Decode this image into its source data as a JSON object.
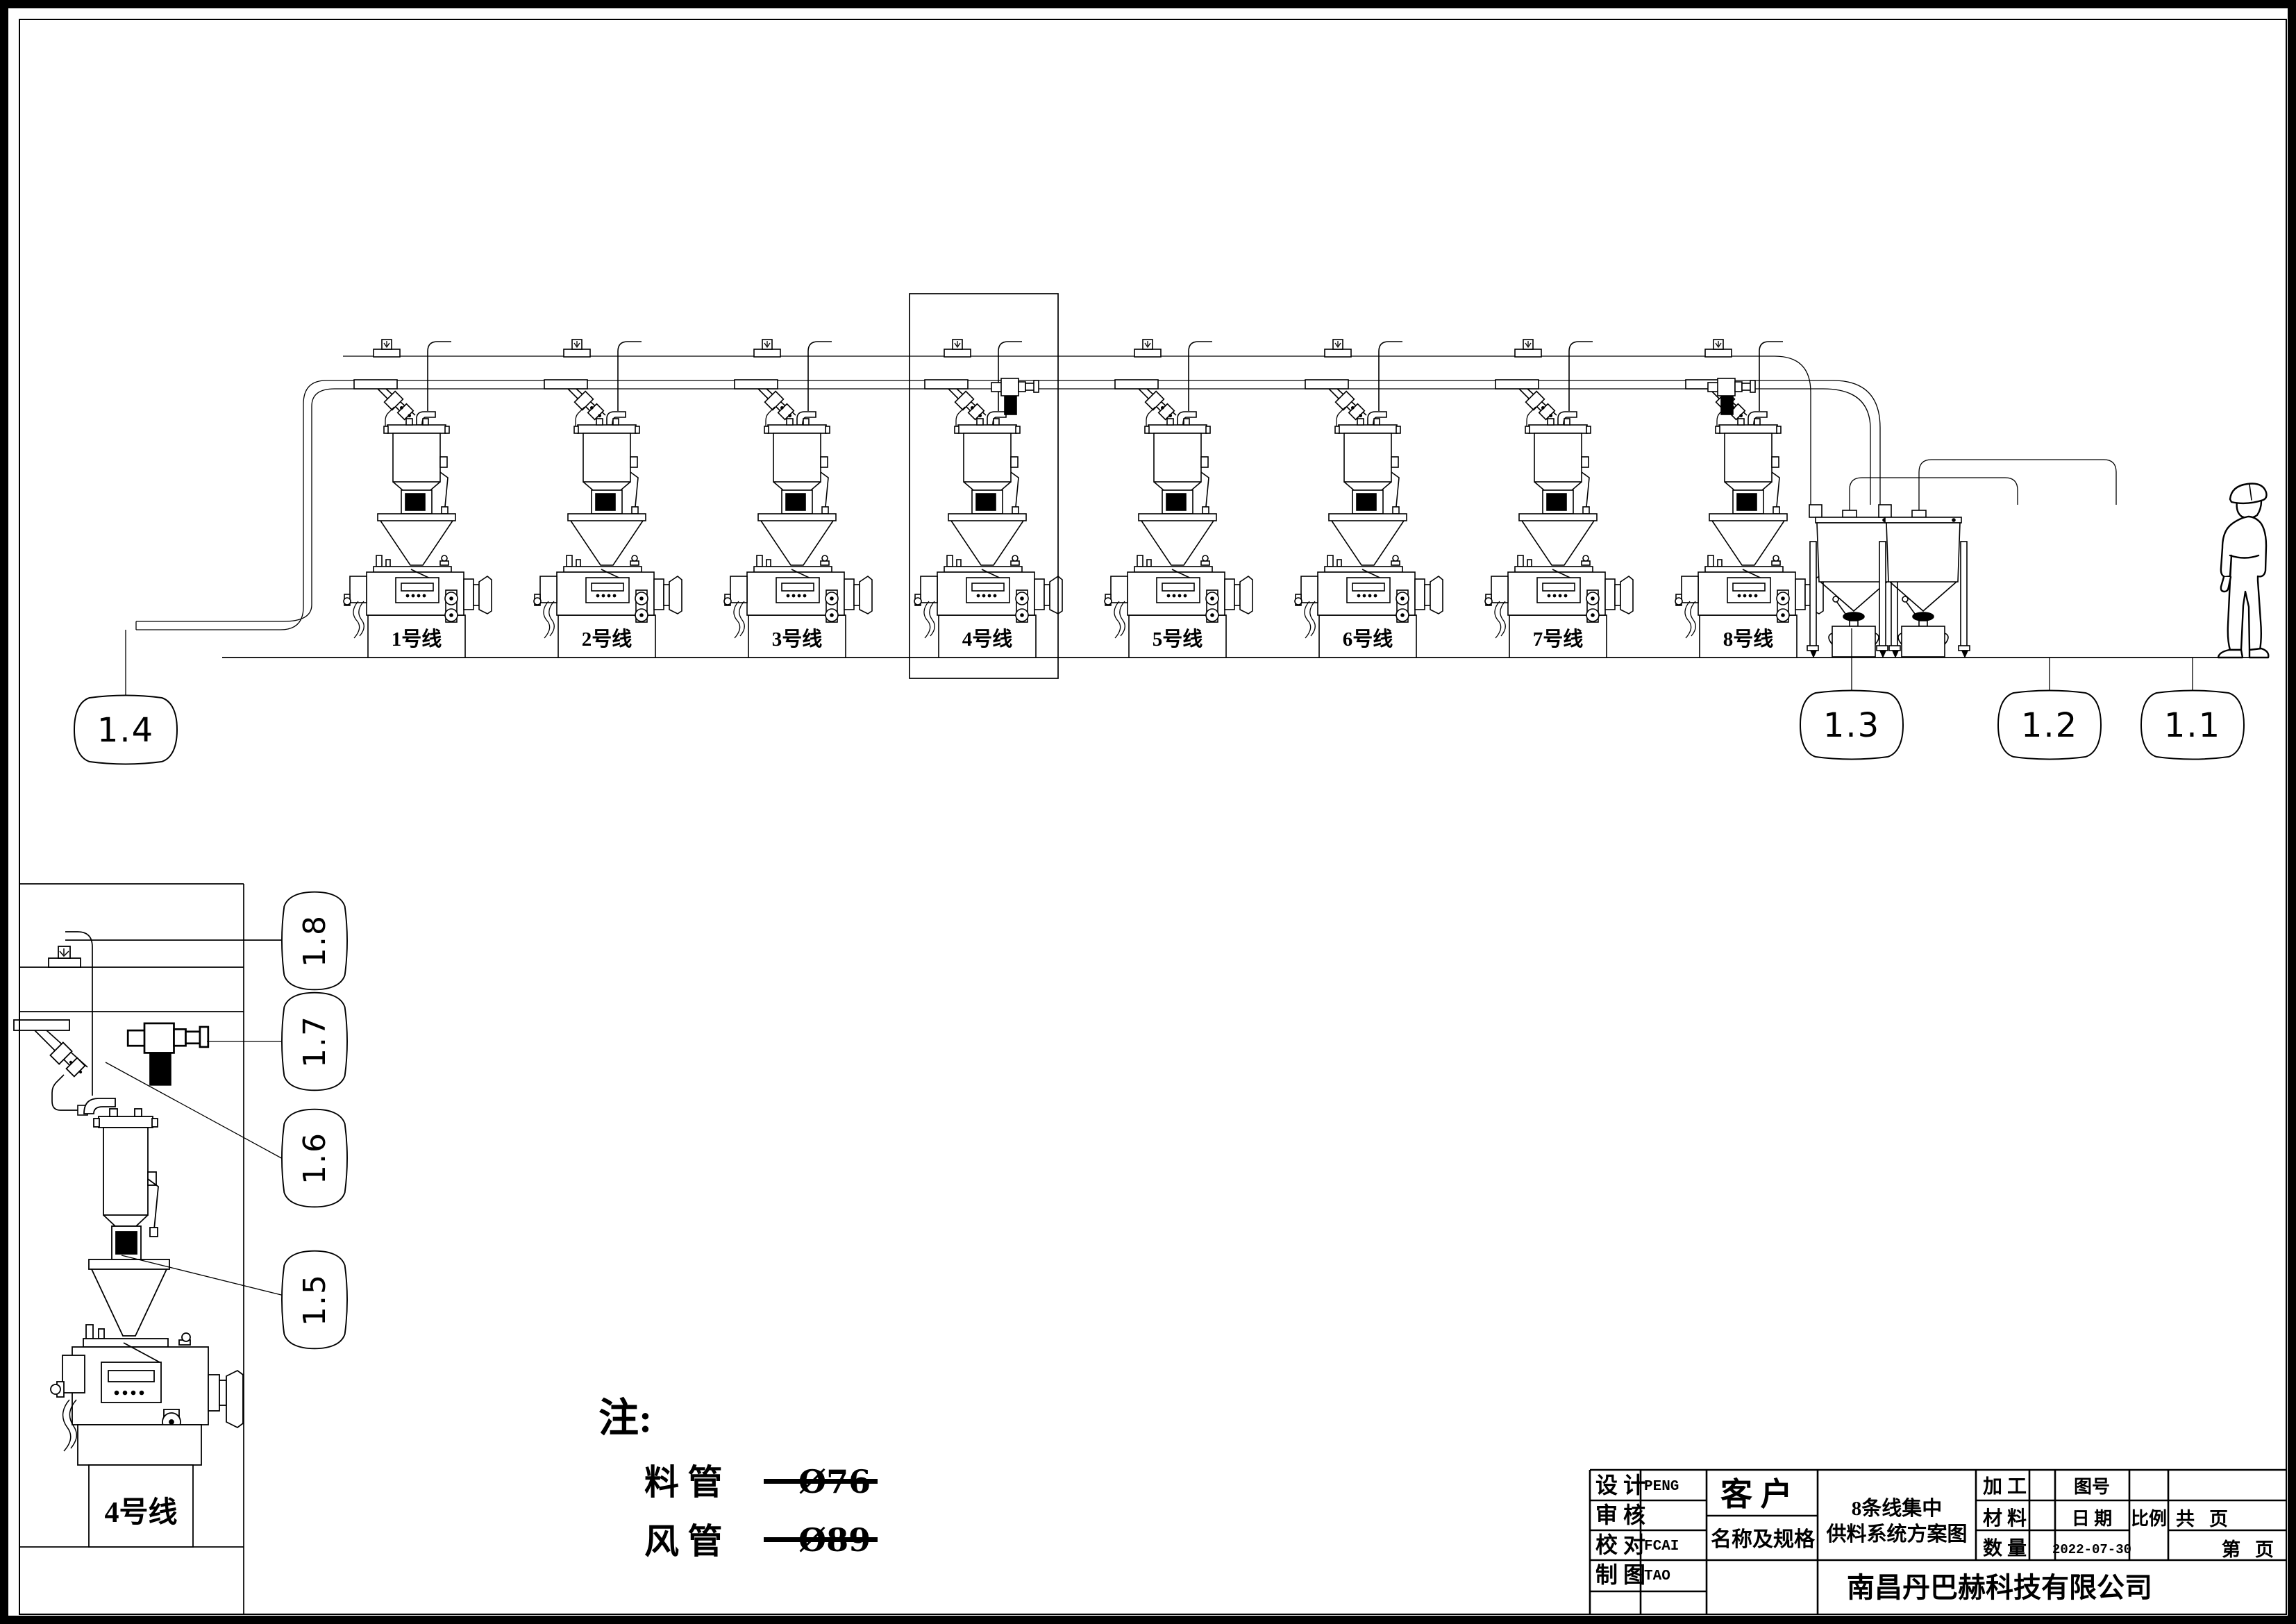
{
  "drawing": {
    "units": [
      {
        "label": "1号线"
      },
      {
        "label": "2号线"
      },
      {
        "label": "3号线"
      },
      {
        "label": "4号线"
      },
      {
        "label": "5号线"
      },
      {
        "label": "6号线"
      },
      {
        "label": "7号线"
      },
      {
        "label": "8号线"
      }
    ],
    "detail_unit_label": "4号线",
    "main_balloons": [
      {
        "id": "1.4"
      },
      {
        "id": "1.3"
      },
      {
        "id": "1.2"
      },
      {
        "id": "1.1"
      }
    ],
    "detail_balloons": [
      {
        "id": "1.8"
      },
      {
        "id": "1.7"
      },
      {
        "id": "1.6"
      },
      {
        "id": "1.5"
      }
    ],
    "notes": {
      "heading": "注:",
      "items": [
        {
          "name": "料 管",
          "value": "Ø76"
        },
        {
          "name": "风 管",
          "value": "Ø89"
        }
      ]
    }
  },
  "title_block": {
    "designer_label": "设 计",
    "designer_value": "PENG",
    "reviewer_label": "审 核",
    "checker_label": "校 对",
    "checker_value": "FCAI",
    "drafter_label": "制 图",
    "drafter_value": "TAO",
    "customer_label": "客 户",
    "name_spec_label": "名称及规格",
    "drawing_name_line1": "8条线集中",
    "drawing_name_line2": "供料系统方案图",
    "process_label": "加 工",
    "material_label": "材 料",
    "quantity_label": "数 量",
    "drawing_no_label": "图号",
    "date_label": "日 期",
    "date_value": "2022-07-30",
    "scale_label": "比例",
    "total_label": "共",
    "total_pages_label": "页",
    "page_label": "第",
    "page_pages_label": "页",
    "company": "南昌丹巴赫科技有限公司"
  }
}
